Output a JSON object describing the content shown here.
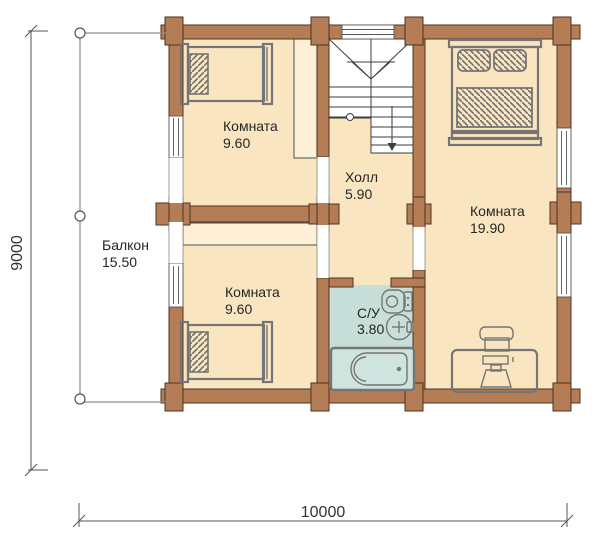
{
  "plan": {
    "type": "house-floor-plan",
    "balcony": {
      "name": "Балкон",
      "area": "15.50"
    },
    "room_top_left": {
      "name": "Комната",
      "area": "9.60"
    },
    "hall": {
      "name": "Холл",
      "area": "5.90"
    },
    "room_right": {
      "name": "Комната",
      "area": "19.90"
    },
    "room_bottom_left": {
      "name": "Комната",
      "area": "9.60"
    },
    "bathroom": {
      "name": "С/У",
      "area": "3.80"
    },
    "dimensions": {
      "vertical": "9000",
      "horizontal": "10000"
    },
    "colors": {
      "wall": "#b57d55",
      "room_fill": "#fae5c1",
      "closet_fill": "#fdf0d6",
      "wet_room_fill": "#c8ded9",
      "bathtub_fill": "#cfe3df",
      "furniture_stroke": "#757575",
      "wall_outline": "#4a3322"
    },
    "icons": [
      "balcony-post",
      "window",
      "single-bed",
      "double-bed",
      "wardrobe",
      "stairs-down-arrow",
      "toilet",
      "sink",
      "bathtub",
      "desk-with-chair"
    ]
  }
}
